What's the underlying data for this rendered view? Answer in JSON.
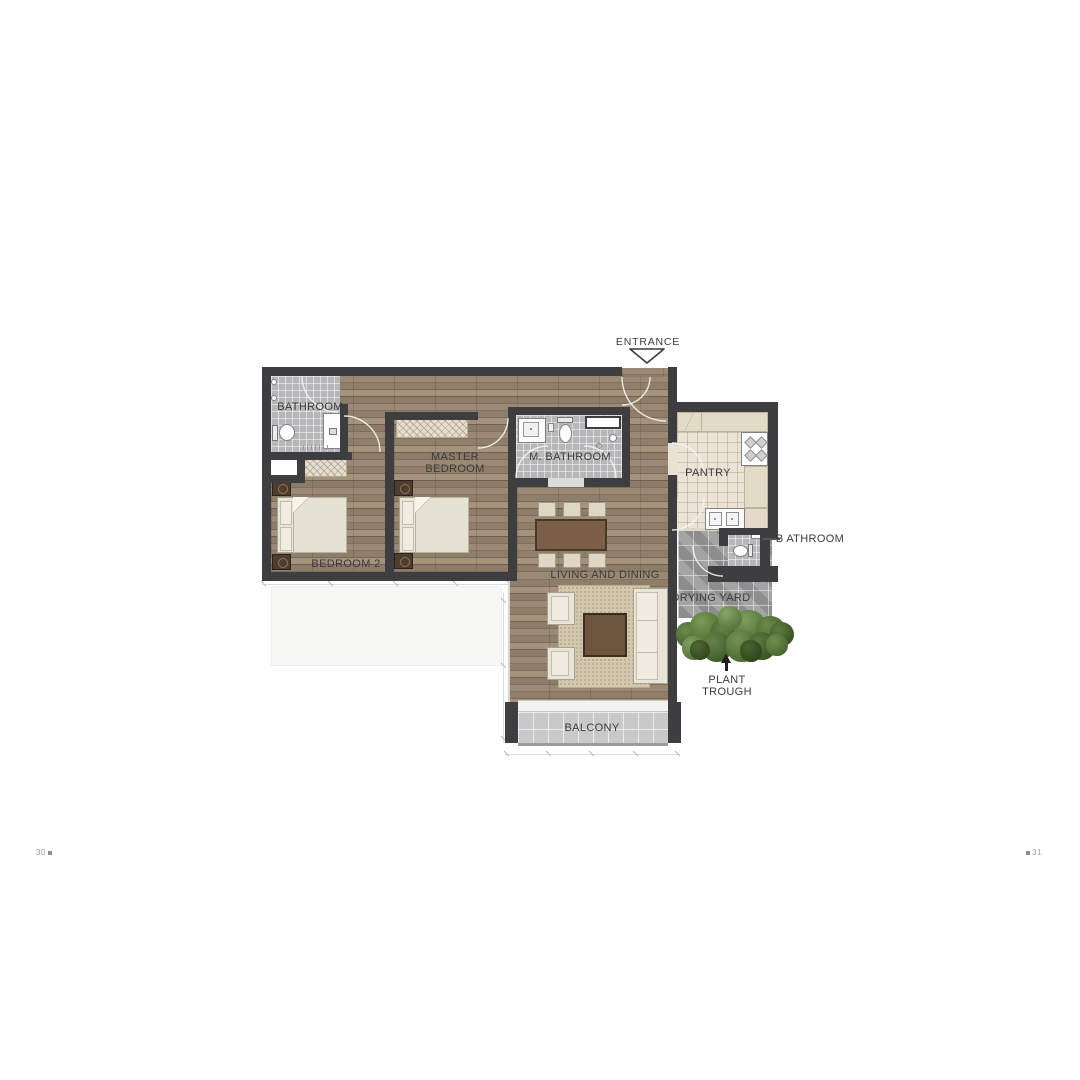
{
  "floor_plan": {
    "entrance_label": "ENTRANCE",
    "room_labels": {
      "bathroom": "BATHROOM",
      "master_bedroom": [
        "MASTER",
        "BEDROOM"
      ],
      "m_bathroom": "M. BATHROOM",
      "pantry": "PANTRY",
      "b_athroom": "B ATHROOM",
      "bedroom_2": "BEDROOM 2",
      "living_and_dining": "LIVING AND DINING",
      "drying_yard": "DRYING YARD",
      "plant_trough": [
        "PLANT",
        "TROUGH"
      ],
      "balcony": "BALCONY"
    },
    "icons": {
      "entrance_marker": "open-triangle-down",
      "plant_trough_marker": "arrow-up"
    }
  },
  "footer": {
    "left_page": "30",
    "right_page": "31"
  },
  "colors": {
    "wall": "#3e3d3f",
    "wood": "#8c7b69",
    "bath_tile": "#b7b7b9",
    "pantry_floor": "#ebe3d5",
    "counter": "#e3dac8",
    "yard_tile": "#9d9d9d",
    "balcony_tile": "#c9c9c9",
    "fabric": "#e8e4d7",
    "furn_wood": "#7b5f48",
    "furn_dark": "#4e3d2f",
    "rug": "#d3c7ad",
    "plant": "#4c6632",
    "label_text": "#3b3b3b"
  }
}
